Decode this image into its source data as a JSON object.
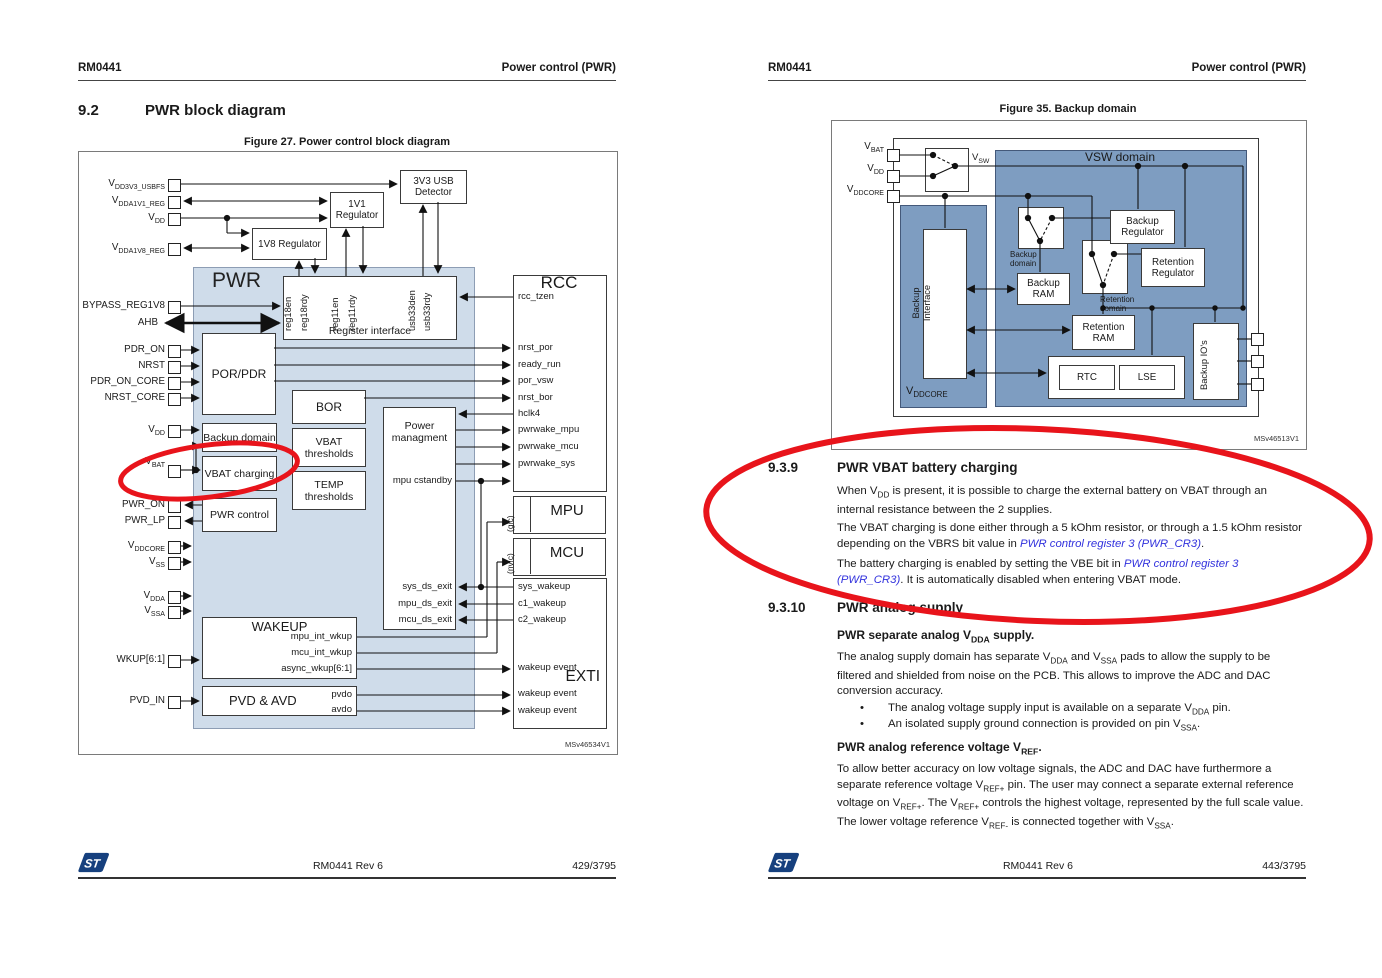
{
  "colors": {
    "annotation_red": "#e8141b",
    "pwr_fill": "#cfdcea",
    "vsw_fill": "#7e9dc1",
    "link_blue": "#3232dd"
  },
  "left": {
    "header": {
      "id": "RM0441",
      "title": "Power control (PWR)"
    },
    "section": {
      "num": "9.2",
      "title": "PWR block diagram"
    },
    "fig": {
      "caption": "Figure 27. Power control block diagram",
      "watermark": "MSv46534V1",
      "pwr": "PWR",
      "usb_det": "3V3 USB Detector",
      "reg1v1": "1V1 Regulator",
      "reg1v8": "1V8 Regulator",
      "reg_iface": "Register interface",
      "reg18en": "reg18en",
      "reg18rdy": "reg18rdy",
      "reg11en": "reg11en",
      "reg11rdy": "reg11rdy",
      "usb33den": "usb33den",
      "usb33rdy": "usb33rdy",
      "rcc": "RCC",
      "rcc_tzen": "rcc_tzen",
      "nrst_por": "nrst_por",
      "ready_run": "ready_run",
      "por_vsw": "por_vsw",
      "nrst_bor": "nrst_bor",
      "hclk4": "hclk4",
      "pwrwake_mpu": "pwrwake_mpu",
      "pwrwake_mcu": "pwrwake_mcu",
      "pwrwake_sys": "pwrwake_sys",
      "por_pdr": "POR/PDR",
      "bor": "BOR",
      "vbat_thr": "VBAT thresholds",
      "temp_thr": "TEMP thresholds",
      "pwr_mgmt": "Power managment",
      "mpu_cstandby": "mpu cstandby",
      "backup_domain": "Backup domain",
      "vbat_charging": "VBAT charging",
      "pwr_control": "PWR control",
      "sys_ds_exit": "sys_ds_exit",
      "mpu_ds_exit": "mpu_ds_exit",
      "mcu_ds_exit": "mcu_ds_exit",
      "mpu": "MPU",
      "gic": "(gic)",
      "mcu": "MCU",
      "nvic": "(nvic)",
      "exti": "EXTI",
      "sys_wakeup": "sys_wakeup",
      "c1_wakeup": "c1_wakeup",
      "c2_wakeup": "c2_wakeup",
      "wakeup_event": "wakeup event",
      "wakeup": "WAKEUP",
      "mpu_int_wkup": "mpu_int_wkup",
      "mcu_int_wkup": "mcu_int_wkup",
      "async_wkup": "async_wkup[6:1]",
      "pvd_avd": "PVD & AVD",
      "pvdo": "pvdo",
      "avdo": "avdo",
      "pins": [
        "V~DD3V3_USBFS~",
        "V~DDA1V1_REG~",
        "V~DD~",
        "V~DDA1V8_REG~",
        "BYPASS_REG1V8",
        "AHB",
        "PDR_ON",
        "NRST",
        "PDR_ON_CORE",
        "NRST_CORE",
        "V~DD~",
        "V~BAT~",
        "PWR_ON",
        "PWR_LP",
        "V~DDCORE~",
        "V~SS~",
        "V~DDA~",
        "V~SSA~",
        "WKUP[6:1]",
        "PVD_IN"
      ]
    },
    "footer": {
      "rev": "RM0441 Rev 6",
      "page": "429/3795"
    }
  },
  "right": {
    "header": {
      "id": "RM0441",
      "title": "Power control (PWR)"
    },
    "fig": {
      "caption": "Figure 35. Backup domain",
      "watermark": "MSv46513V1",
      "vsw_domain": "VSW domain",
      "vsw": "V~SW~",
      "pins": [
        "V~BAT~",
        "V~DD~",
        "V~DDCORE~"
      ],
      "backup_reg": "Backup Regulator",
      "retention_reg": "Retention Regulator",
      "backup_ram": "Backup RAM",
      "retention_ram": "Retention RAM",
      "backup_domain": "Backup domain",
      "retention_domain": "Retention domain",
      "backup_iface": "Backup Interface",
      "vddcore": "V~DDCORE~",
      "rtc": "RTC",
      "lse": "LSE",
      "backup_ios": "Backup IO's"
    },
    "s939": {
      "num": "9.3.9",
      "title": "PWR VBAT battery charging",
      "p1": "When V~DD~ is present, it is possible to charge the external battery on VBAT through an internal resistance between the 2 supplies.",
      "p2": "The VBAT charging is done either through a 5 kOhm resistor, or through a 1.5 kOhm resistor depending on the VBRS bit value in ^PWR control register 3 (PWR_CR3)^.",
      "p3": "The battery charging is enabled by setting the VBE bit in ^PWR control register 3 (PWR_CR3)^. It is automatically disabled when entering VBAT mode."
    },
    "s9310": {
      "num": "9.3.10",
      "title": "PWR analog supply",
      "h1": "PWR separate analog V~DDA~ supply.",
      "p1": "The analog supply domain has separate V~DDA~ and V~SSA~ pads to allow the supply to be filtered and shielded from noise on the PCB. This allows to improve the ADC and DAC conversion accuracy.",
      "b1": "The analog voltage supply input is available on a separate V~DDA~ pin.",
      "b2": "An isolated supply ground connection is provided on pin V~SSA~.",
      "h2": "PWR analog reference voltage V~REF~.",
      "p2": "To allow better accuracy on low voltage signals, the ADC and DAC have furthermore a separate reference voltage V~REF+~ pin. The user may connect a separate external reference voltage on V~REF+~. The V~REF+~ controls the highest voltage, represented by the full scale value. The lower voltage reference V~REF-~ is connected together with V~SSA~."
    },
    "footer": {
      "rev": "RM0441 Rev 6",
      "page": "443/3795"
    }
  }
}
